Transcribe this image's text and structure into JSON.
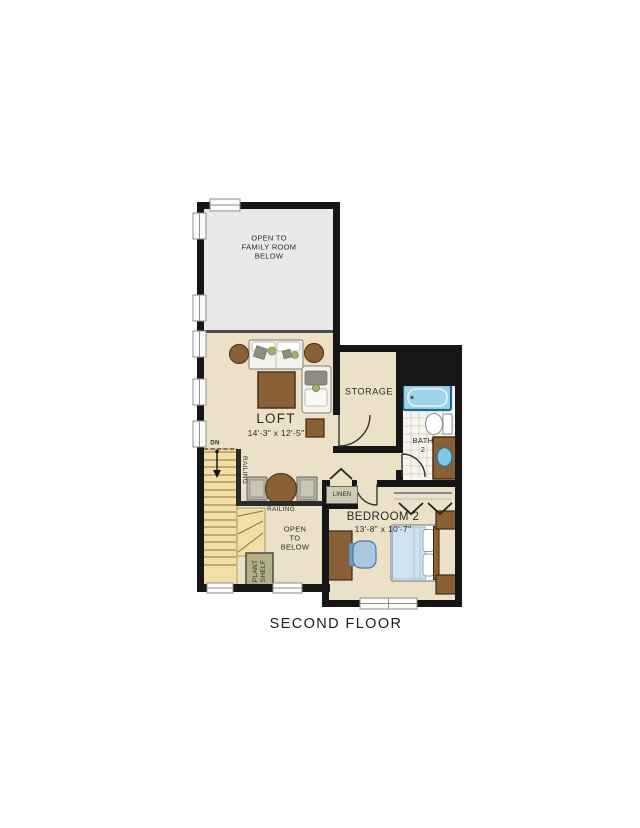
{
  "title": "SECOND FLOOR",
  "rooms": {
    "open_family": {
      "label": "OPEN TO\nFAMILY ROOM\nBELOW"
    },
    "loft": {
      "name": "LOFT",
      "dims": "14'-3\" x 12'-5\""
    },
    "storage": {
      "name": "STORAGE"
    },
    "bath": {
      "name": "BATH\n2"
    },
    "bedroom": {
      "name": "BEDROOM 2",
      "dims": "13'-8\" x 10'-7\""
    },
    "linen": {
      "name": "LINEN"
    },
    "open_below": {
      "label": "OPEN\nTO\nBELOW"
    },
    "plant_shelf": {
      "label": "PLANT\nSHELF"
    }
  },
  "annotations": {
    "railing_vertical": "RAILING",
    "railing_horizontal": "RAILING",
    "stairs_down": "DN"
  },
  "colors": {
    "wall": "#161616",
    "divider": "#4a4a4a",
    "floor": "#eae1c8",
    "open_area": "#e9e9e8",
    "stairs": "#f2dfa6",
    "wood": "#8a6136",
    "wood_dark": "#4f3012",
    "tub": "#9fd4e8",
    "tub_frame": "#20688c",
    "tile": "#f7f5ee",
    "bed": "#cfe4f0",
    "chair_blue": "#a9c8e0",
    "shelf_green": "#b2b089",
    "linen_bg": "#cfcbb2",
    "upholstery": "#f4f2ec",
    "cushion_gray": "#8f8d80",
    "plant_green": "#a4b06a",
    "window": "#fbfbfb"
  }
}
